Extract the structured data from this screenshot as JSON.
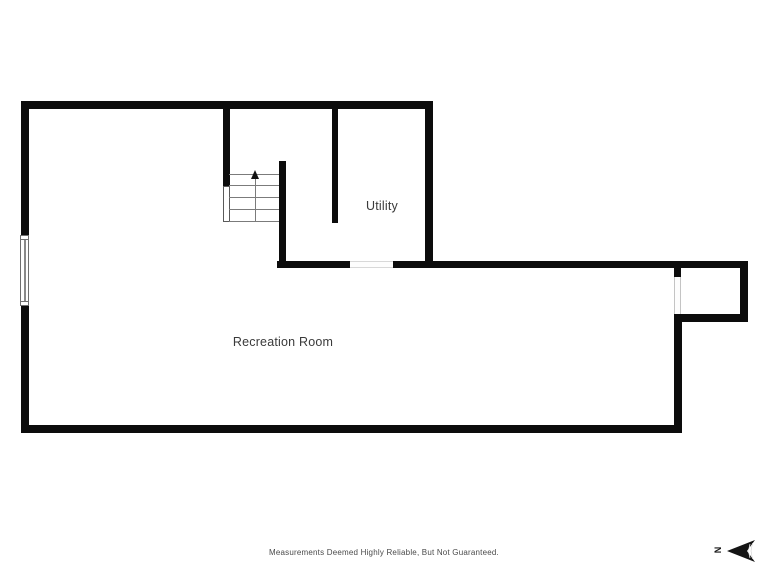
{
  "floorplan": {
    "rooms": [
      {
        "id": "utility",
        "label": "Utility"
      },
      {
        "id": "recreation-room",
        "label": "Recreation Room"
      }
    ],
    "features": {
      "stairs": {
        "direction": "up",
        "tread_count": 5
      },
      "window": "left-wall-window",
      "compass": {
        "label": "N",
        "pointing": "left"
      }
    },
    "colors": {
      "wall": "#0c0c0c",
      "label_text": "#3a3a3a",
      "disclaimer_text": "#4a4a4a",
      "background": "#ffffff"
    }
  },
  "footer": {
    "disclaimer": "Measurements Deemed Highly Reliable, But Not Guaranteed."
  }
}
